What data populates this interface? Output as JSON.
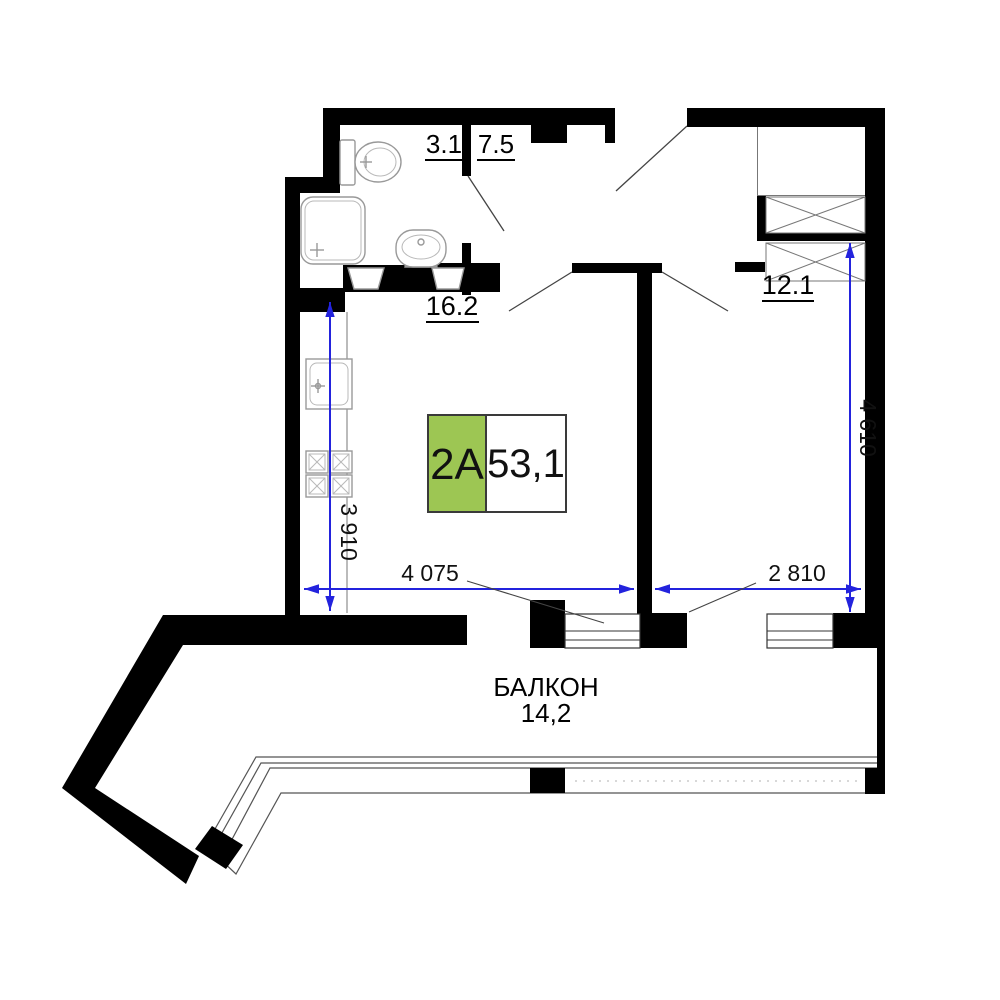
{
  "plan_title": "apartment floor plan",
  "unit_badge": {
    "type_label": "2A",
    "total_area": "53,1"
  },
  "rooms": {
    "bathroom": {
      "area": "3.1"
    },
    "hallway": {
      "area": "7.5"
    },
    "living_kitchen": {
      "area": "16.2"
    },
    "bedroom": {
      "area": "12.1"
    },
    "balcony": {
      "name": "БАЛКОН",
      "area": "14,2"
    }
  },
  "dimensions": {
    "kitchen_depth": "3 910",
    "living_width": "4 075",
    "bedroom_width": "2 810",
    "bedroom_depth": "4 610"
  },
  "colors": {
    "wall": "#000000",
    "dimension_blue": "#2323dd",
    "badge_green": "#9dc653",
    "fixture_gray": "#999999"
  },
  "icons": [
    "toilet-icon",
    "shower-icon",
    "washbasin-icon",
    "kitchen-sink-icon",
    "stove-icon",
    "wardrobe-icon"
  ]
}
